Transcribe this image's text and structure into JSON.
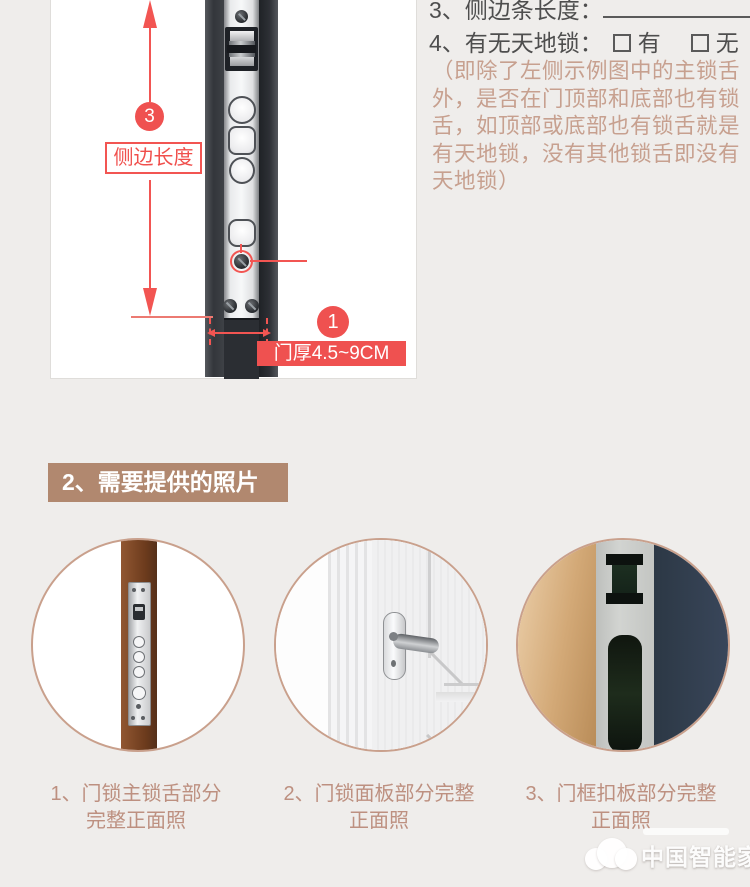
{
  "colors": {
    "accent_red": "#ef5150",
    "tan_heading_bg": "#b1886f",
    "caption_text": "#bd9080",
    "note_text": "#c7a08f",
    "dark_text": "#4e4e4e"
  },
  "diagram": {
    "step3_badge": "3",
    "side_length_label": "侧边长度",
    "step1_badge": "1",
    "door_thickness_label": "门厚4.5~9CM"
  },
  "form": {
    "line3_label": "3、侧边条长度：",
    "line4_label": "4、有无天地锁：",
    "option_yes": "有",
    "option_no": "无",
    "note": "（即除了左侧示例图中的主锁舌外，是否在门顶部和底部也有锁舌，如顶部或底部也有锁舌就是有天地锁，没有其他锁舌即没有天地锁）"
  },
  "section2": {
    "heading": "2、需要提供的照片"
  },
  "photos": [
    {
      "caption_line1": "1、门锁主锁舌部分",
      "caption_line2": "完整正面照"
    },
    {
      "caption_line1": "2、门锁面板部分完整",
      "caption_line2": "正面照"
    },
    {
      "caption_line1": "3、门框扣板部分完整",
      "caption_line2": "正面照"
    }
  ],
  "watermark": {
    "site_name": "中国智能家网"
  }
}
